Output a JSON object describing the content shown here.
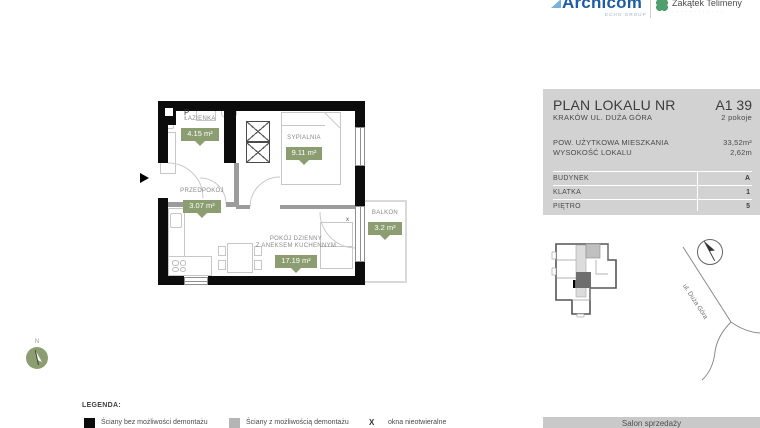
{
  "header": {
    "archicom": "Archicom",
    "archicom_sub": "ECHO GROUP",
    "estate": "Zakątek Telimeny",
    "estate_tagline": "· · · · · · · · · · · ·"
  },
  "panel": {
    "title": "PLAN LOKALU NR",
    "unit": "A1 39",
    "subtitle": "KRAKÓW UL. DUŻA GÓRA",
    "rooms_count": "2 pokoje",
    "specs": [
      {
        "label": "POW. UŻYTKOWA MIESZKANIA",
        "value": "33,52m²"
      },
      {
        "label": "WYSOKOŚĆ LOKALU",
        "value": "2,62m"
      }
    ],
    "table": [
      {
        "label": "BUDYNEK",
        "value": "A"
      },
      {
        "label": "KLATKA",
        "value": "1"
      },
      {
        "label": "PIĘTRO",
        "value": "5"
      }
    ],
    "street": "ul. Duża Góra",
    "footer": "Salon sprzedaży"
  },
  "plan": {
    "rooms": [
      {
        "name": "ŁAZIENKA",
        "area": "4.15 m²"
      },
      {
        "name": "SYPIALNIA",
        "area": "9.11 m²"
      },
      {
        "name": "PRZEDPOKÓJ",
        "area": "3.07 m²"
      },
      {
        "name": "POKÓJ DZIENNY",
        "name2": "Z ANEKSEM KUCHENNYM",
        "area": "17.19 m²"
      },
      {
        "name": "BALKON",
        "area": "3.2 m²"
      }
    ],
    "markers": {
      "entrance": "P",
      "nonopening": "x",
      "north": "N"
    }
  },
  "legend": {
    "title": "LEGENDA:",
    "items": [
      {
        "symbol": "",
        "label": "Ściany bez możliwości demontażu"
      },
      {
        "symbol": "",
        "label": "Ściany z możliwością demontażu"
      },
      {
        "symbol": "X",
        "label": "okna nieotwieralne"
      }
    ]
  },
  "colors": {
    "badge_green": "#8c9e71",
    "panel_gray": "#d2d2d2",
    "accent_blue": "#1d5da6",
    "clover_green": "#4f9e6b"
  }
}
